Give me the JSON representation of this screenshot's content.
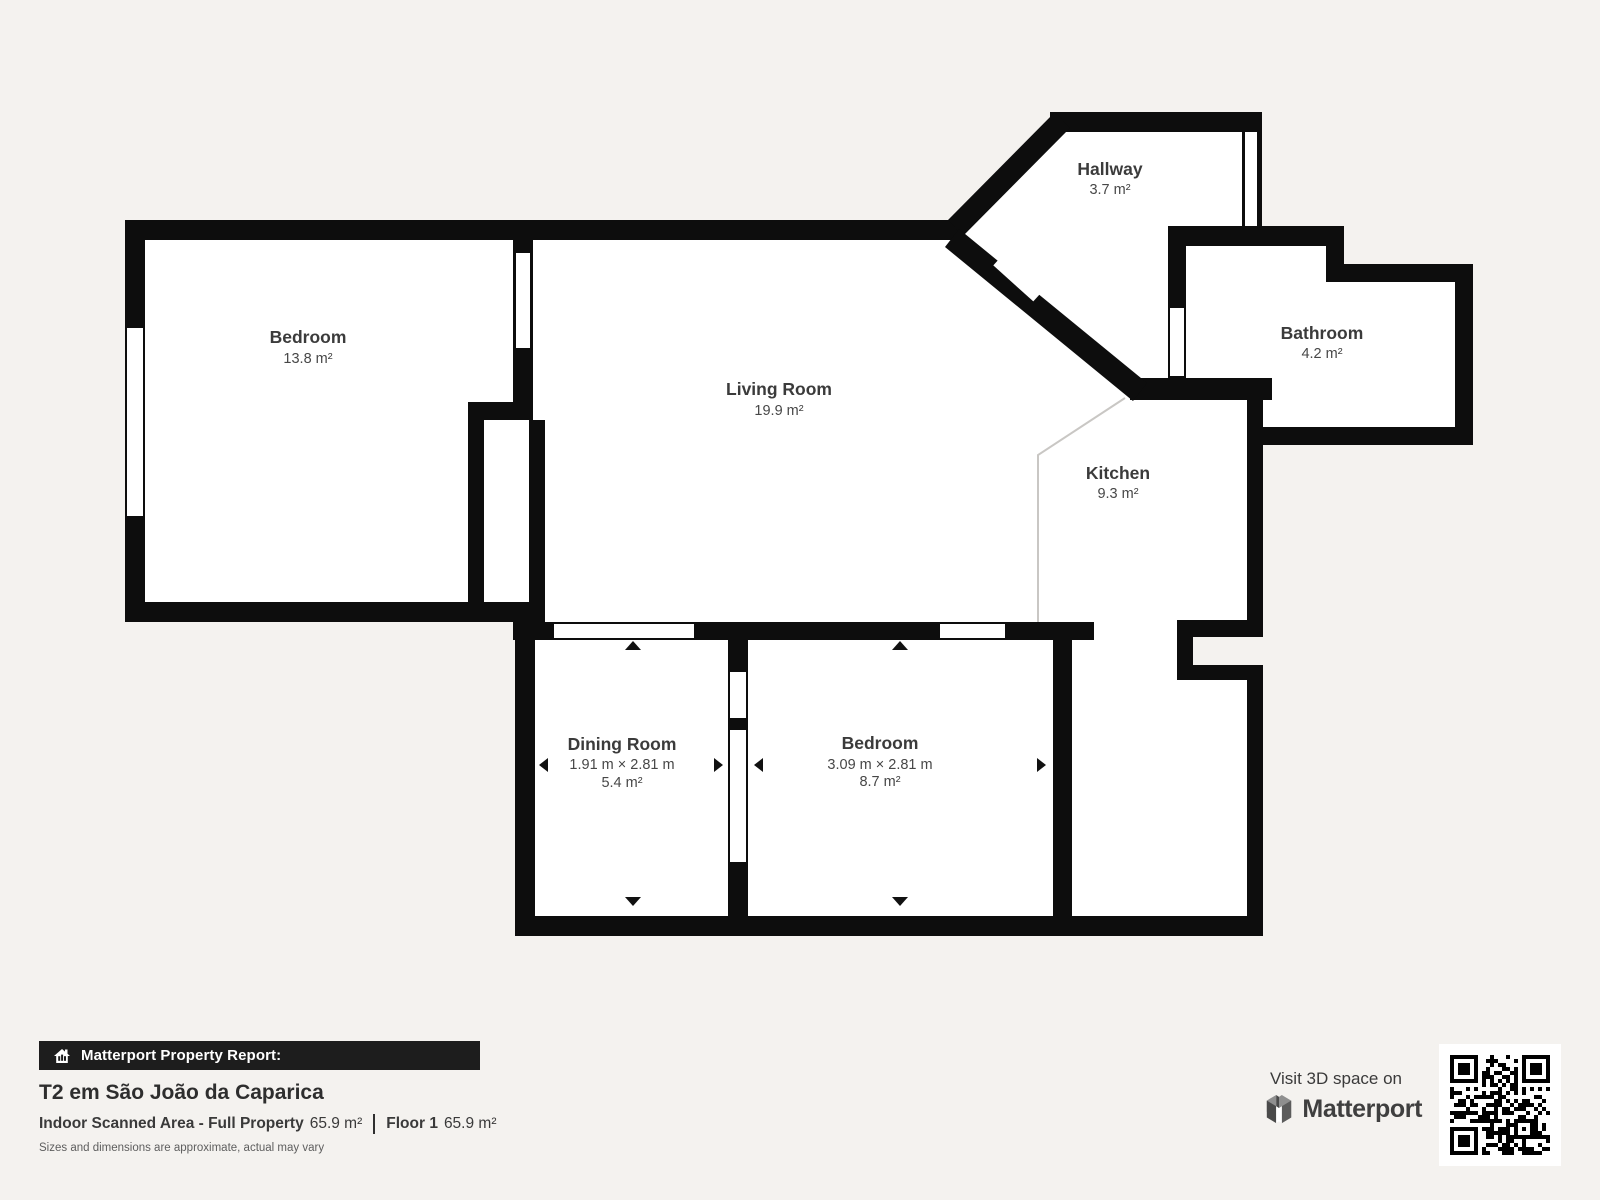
{
  "canvas": {
    "background": "#f4f2ef",
    "wall_color": "#0d0d0d",
    "room_fill": "#ffffff",
    "kitchen_divider_color": "#c9c7c4"
  },
  "rooms": {
    "bedroom1": {
      "name": "Bedroom",
      "area": "13.8 m²"
    },
    "living": {
      "name": "Living Room",
      "area": "19.9 m²"
    },
    "hallway": {
      "name": "Hallway",
      "area": "3.7 m²"
    },
    "bathroom": {
      "name": "Bathroom",
      "area": "4.2 m²"
    },
    "kitchen": {
      "name": "Kitchen",
      "area": "9.3 m²"
    },
    "dining": {
      "name": "Dining Room",
      "dims": "1.91 m × 2.81 m",
      "area": "5.4 m²"
    },
    "bedroom2": {
      "name": "Bedroom",
      "dims": "3.09 m × 2.81 m",
      "area": "8.7 m²"
    }
  },
  "report": {
    "bar_label": "Matterport Property Report:",
    "title": "T2 em São João da Caparica",
    "indoor_label": "Indoor Scanned Area - Full Property",
    "indoor_value": "65.9 m²",
    "floor_label": "Floor 1",
    "floor_value": "65.9 m²",
    "disclaimer": "Sizes and dimensions are approximate, actual may vary"
  },
  "cta": {
    "visit_text": "Visit 3D space on",
    "brand": "Matterport"
  }
}
